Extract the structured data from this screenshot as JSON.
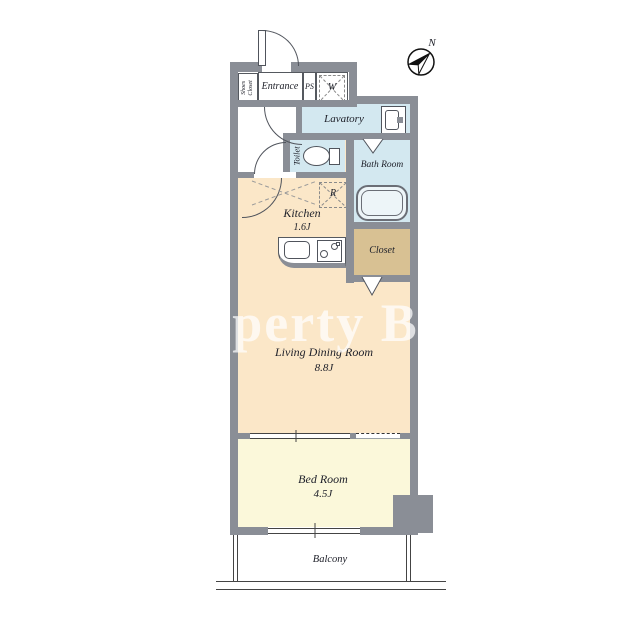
{
  "compass": {
    "north": "N"
  },
  "watermark": {
    "text": "perty Ba"
  },
  "rooms": {
    "shoes_closet": {
      "label": "Shoes\nCloset"
    },
    "entrance": {
      "label": "Entrance"
    },
    "pipe_space": {
      "label": "PS"
    },
    "washing_machine": {
      "label": "W"
    },
    "lavatory": {
      "label": "Lavatory"
    },
    "toilet": {
      "label": "Toilet"
    },
    "bath_room": {
      "label": "Bath Room"
    },
    "kitchen": {
      "label": "Kitchen",
      "size": "1.6J"
    },
    "refrigerator": {
      "label": "R"
    },
    "closet": {
      "label": "Closet"
    },
    "living_dining": {
      "label": "Living Dining Room",
      "size": "8.8J"
    },
    "bed_room": {
      "label": "Bed Room",
      "size": "4.5J"
    },
    "balcony": {
      "label": "Balcony"
    }
  },
  "colors": {
    "wall": "#8a8e96",
    "water_room": "#d3e8f0",
    "main_room": "#fbe7c8",
    "bed_room": "#fbf8da",
    "closet": "#d8c193",
    "outline": "#55595f"
  }
}
